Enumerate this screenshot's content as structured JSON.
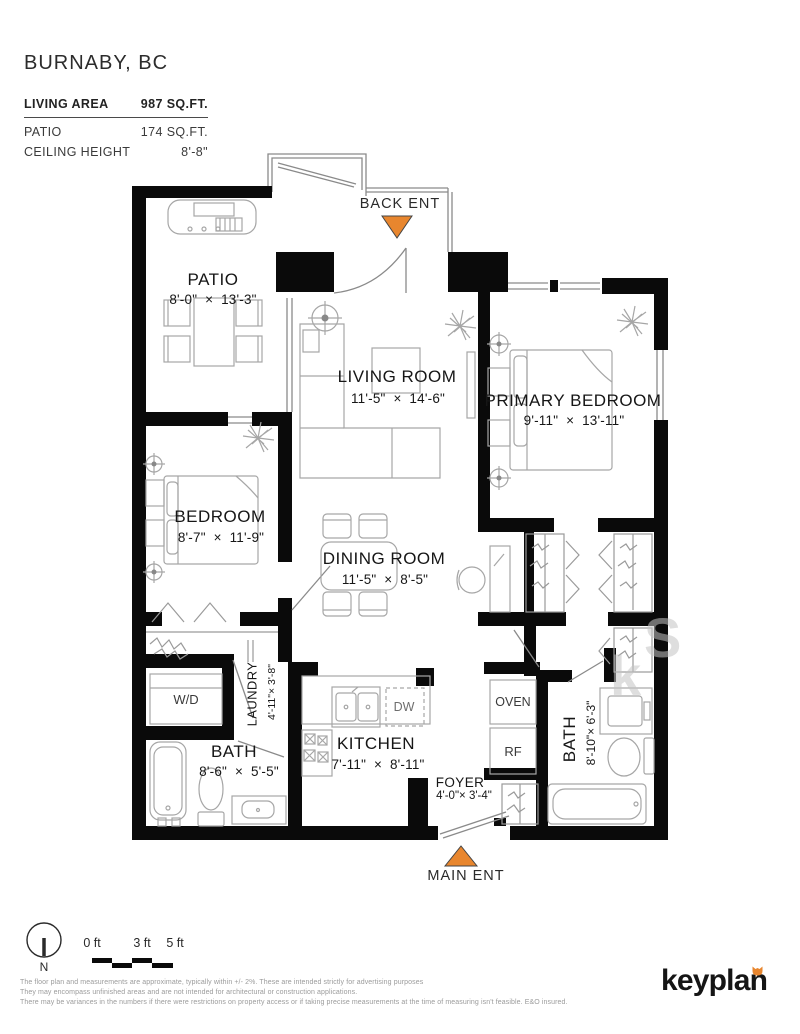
{
  "header": {
    "city": "BURNABY, BC",
    "living_area_label": "LIVING AREA",
    "living_area_value": "987 SQ.FT.",
    "patio_label": "PATIO",
    "patio_value": "174 SQ.FT.",
    "ceiling_label": "CEILING HEIGHT",
    "ceiling_value": "8'-8\""
  },
  "plan": {
    "back_entrance": "BACK ENT",
    "main_entrance": "MAIN ENT",
    "rooms": {
      "patio": {
        "name": "PATIO",
        "dims": "8'-0\"  ×  13'-3\""
      },
      "living": {
        "name": "LIVING ROOM",
        "dims": "11'-5\"  ×  14'-6\""
      },
      "primary": {
        "name": "PRIMARY BEDROOM",
        "dims": "9'-11\"  ×  13'-11\""
      },
      "bedroom": {
        "name": "BEDROOM",
        "dims": "8'-7\"  ×  11'-9\""
      },
      "dining": {
        "name": "DINING ROOM",
        "dims": "11'-5\"  ×  8'-5\""
      },
      "kitchen": {
        "name": "KITCHEN",
        "dims": "7'-11\"  ×  8'-11\""
      },
      "bath1": {
        "name": "BATH",
        "dims": "8'-6\"  ×  5'-5\""
      },
      "bath2": {
        "name": "BATH",
        "dims": "8'-10\"× 6'-3\""
      },
      "laundry": {
        "name": "LAUNDRY",
        "dims": "4'-11\"× 3'-8\""
      },
      "foyer": {
        "name": "FOYER",
        "dims": "4'-0\"× 3'-4\""
      }
    },
    "fixtures": {
      "wd": "W/D",
      "dw": "DW",
      "oven": "OVEN",
      "rf": "RF"
    }
  },
  "watermark": {
    "l1": "S",
    "l2": "k"
  },
  "footer": {
    "north": "N",
    "scale": {
      "t0": "0 ft",
      "t3": "3 ft",
      "t5": "5 ft"
    },
    "disclaimer1": "The floor plan and measurements are approximate, typically within +/- 2%. These are intended strictly for advertising purposes",
    "disclaimer2": "They may encompass unfinished areas and are not intended for architectural or construction applications.",
    "disclaimer3": "There may be variances in the numbers if there were restrictions on property access or if taking precise measurements at the time of measuring isn't feasible. E&O insured.",
    "logo": "keyplan"
  },
  "colors": {
    "accent": "#e8862e",
    "wall": "#0a0a0a"
  }
}
